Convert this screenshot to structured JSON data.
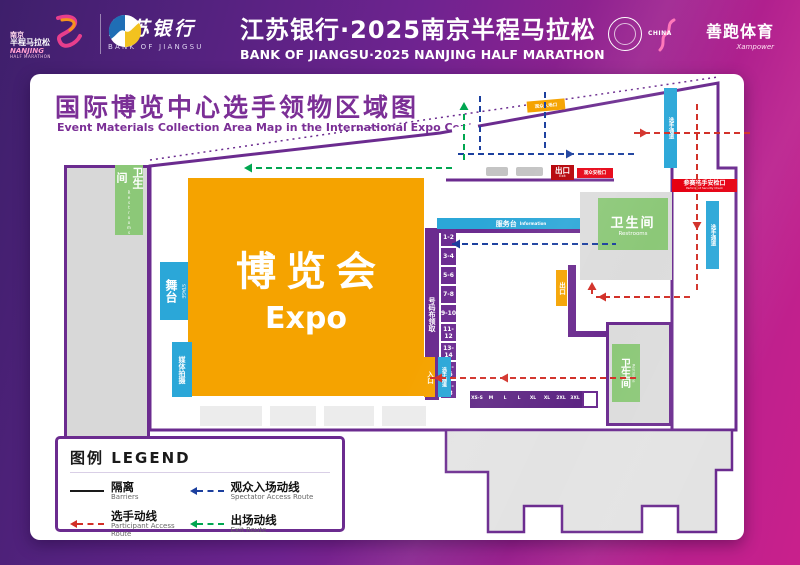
{
  "header": {
    "event_logo": {
      "cn_city": "南京",
      "cn_race": "半程马拉松",
      "en_city": "NANJING",
      "en_race": "HALF MARATHON"
    },
    "bank": {
      "cn": "江苏银行",
      "en": "BANK OF JIANGSU"
    },
    "title": {
      "cn": "江苏银行·2025南京半程马拉松",
      "en": "BANK OF JIANGSU·2025 NANJING HALF MARATHON"
    },
    "partners": {
      "china_athletics": "CHINA",
      "sponsor_cn": "善跑体育",
      "sponsor_en": "Xampower"
    }
  },
  "map": {
    "title": {
      "cn": "国际博览中心选手领物区域图",
      "en": "Event Materials Collection Area Map in the International Expo Center"
    },
    "areas": {
      "expo": {
        "cn": "博览会",
        "en": "Expo"
      },
      "stage": {
        "cn": "舞台",
        "en": "STAGE"
      },
      "media": {
        "cn": "媒体拍摄"
      },
      "restroom": {
        "cn": "卫生间",
        "en": "Restrooms"
      },
      "bib": {
        "cn": "号码布领取",
        "en": "Bib Number Pickup"
      },
      "service": {
        "cn": "服务台",
        "en": "Information"
      }
    },
    "gates": {
      "exit": {
        "cn": "出口",
        "en": "Exit"
      },
      "spectator_security": {
        "cn": "观众安检口"
      },
      "participant_security": {
        "cn": "参赛选手安检口",
        "en": "Participant Security Check"
      },
      "spectator_entrance": {
        "cn": "观众入场口"
      },
      "entry": {
        "cn": "入口"
      },
      "lane": {
        "cn": "选手通道"
      },
      "mid_exit": {
        "cn": "出口"
      },
      "corridor_top": {
        "cn": "选手通道"
      },
      "corridor_right": {
        "cn": "选手通道"
      }
    },
    "booths": [
      "1-2",
      "3-4",
      "5-6",
      "7-8",
      "9-10",
      "11-12",
      "13-14",
      "15-16",
      "17-18"
    ],
    "sizes": [
      "XS-S",
      "M",
      "L",
      "L",
      "XL",
      "XL",
      "2XL",
      "3XL"
    ]
  },
  "legend": {
    "title": "图例 LEGEND",
    "items": [
      {
        "cn": "隔离",
        "en": "Barriers",
        "color": "#1a1a1a",
        "style": "solid"
      },
      {
        "cn": "观众入场动线",
        "en": "Spectator Access Route",
        "color": "#1b3f9e",
        "style": "dashed"
      },
      {
        "cn": "选手动线",
        "en": "Participant Access Route",
        "color": "#d22f27",
        "style": "dashed"
      },
      {
        "cn": "出场动线",
        "en": "Exit Route",
        "color": "#00a650",
        "style": "dashed"
      }
    ]
  },
  "colors": {
    "wall": "#6b2b8f",
    "expo": "#f5a300",
    "cyan": "#2ba7d8",
    "green": "#8cc878",
    "red": "#e60012",
    "bg_purple": "#3e1f6b",
    "bg_magenta": "#c9208c"
  }
}
